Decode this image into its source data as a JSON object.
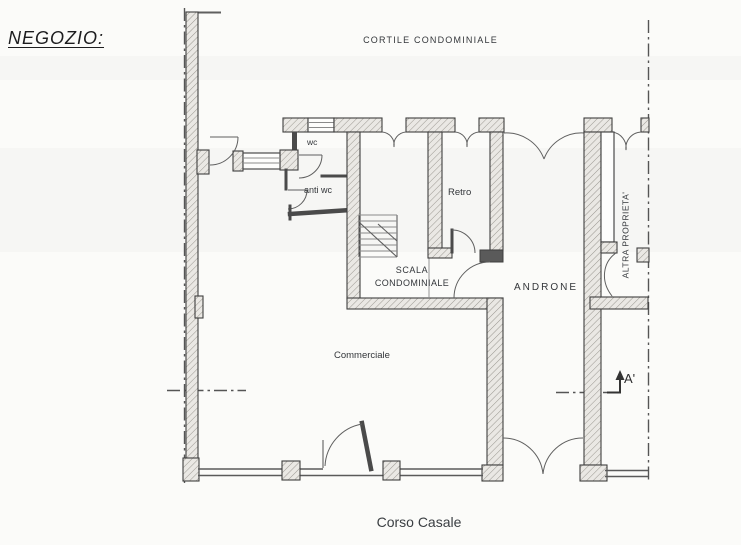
{
  "title": {
    "negozio": "NEGOZIO:"
  },
  "plan": {
    "areas": {
      "cortile": "CORTILE CONDOMINIALE",
      "wc": "wc",
      "anti_wc": "anti wc",
      "retro": "Retro",
      "scala_line1": "SCALA",
      "scala_line2": "CONDOMINIALE",
      "androne": "ANDRONE",
      "commerciale": "Commerciale",
      "altra_proprieta": "ALTRA PROPRIETA'",
      "street": "Corso Casale"
    },
    "section_marker": {
      "label": "A'"
    }
  },
  "colors": {
    "background": "#fbfbf9",
    "wall_outline": "#3f3f3f",
    "wall_fill": "#eae8e4",
    "hatch": "#999690",
    "partition": "#4a4a4a",
    "line": "#5f5f5f",
    "dashdot": "#555555",
    "text": "#33363a"
  }
}
